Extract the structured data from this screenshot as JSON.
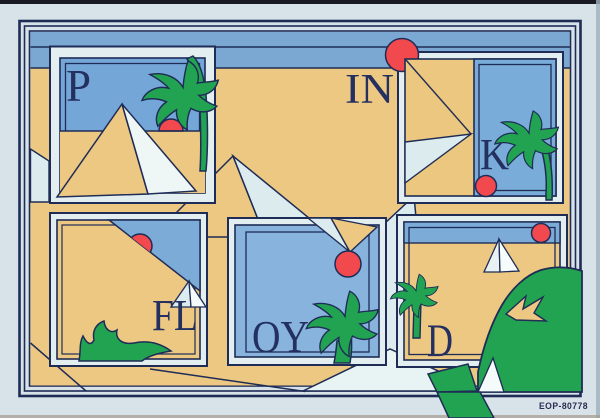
{
  "artwork": {
    "catalog_number": "EOP-80778",
    "letters_spell": "PINK FLOYD",
    "panels": [
      {
        "id": "panel-p",
        "letter": "P",
        "scene": "pyramid, palm tree, setting sun"
      },
      {
        "id": "label-in",
        "letter": "IN",
        "scene": "desert sand, sun behind frame"
      },
      {
        "id": "panel-k",
        "letter": "K",
        "scene": "folded pyramid, palm tree, small sun"
      },
      {
        "id": "panel-fl",
        "letter": "FL",
        "scene": "diagonal horizon, sun, green bush"
      },
      {
        "id": "panel-oy",
        "letter": "OY",
        "scene": "sky, sun hanging from pyramid tip, palm tree"
      },
      {
        "id": "panel-d",
        "letter": "D",
        "scene": "small pyramid, palm tree, sun, large foliage"
      }
    ],
    "colors": {
      "background": "#d7e3e9",
      "outline_navy": "#1e2c56",
      "sky_blue": "#7ba8d2",
      "sand_tan": "#edc883",
      "frame_pale": "#e3eef1",
      "pyramid_pale": "#dcecee",
      "pyramid_white": "#f4fbfa",
      "palm_green": "#22a351",
      "sun_red": "#f2494e"
    }
  }
}
